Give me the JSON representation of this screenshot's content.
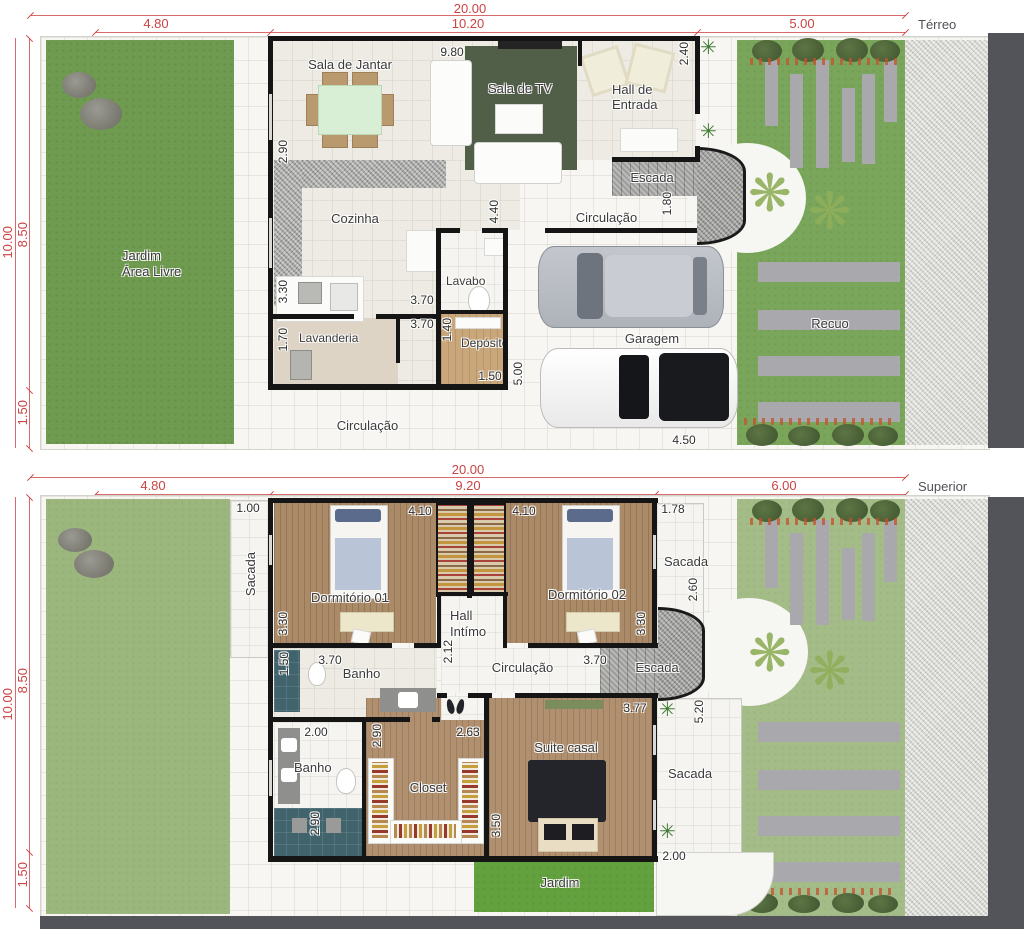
{
  "colors": {
    "dimension_red": "#cb4343",
    "label_dark": "#3b3b3b",
    "wall_black": "#151515",
    "grass_green": "#6f9b50",
    "grass_light": "#9cb77e",
    "rug_green": "#515e48",
    "wood_floor": "#ab8a67",
    "shower_teal": "#41646c",
    "paver_gray": "#a9a9ad",
    "street_gray": "#53545a"
  },
  "terreo": {
    "title": "Térreo",
    "dims": {
      "total": "20.00",
      "seg_left": "4.80",
      "seg_mid": "10.20",
      "seg_right": "5.00",
      "side_total": "10.00",
      "side_upper": "8.50",
      "side_lower": "1.50",
      "sala_width": "9.80",
      "hall_depth": "2.40",
      "jantar_height": "2.90",
      "cozinha_depth": "4.40",
      "escada_width": "1.80",
      "cozinha_height": "3.30",
      "cozinha_width": "3.70",
      "lavanderia_width": "3.70",
      "lavanderia_height": "1.70",
      "deposito_height": "1.40",
      "deposito_width": "1.50",
      "garagem_depth": "5.00",
      "garagem_width": "4.50"
    },
    "labels": {
      "sala_jantar": "Sala de Jantar",
      "sala_tv": "Sala de TV",
      "hall_line1": "Hall de",
      "hall_line2": "Entrada",
      "escada": "Escada",
      "circulacao_sup": "Circulação",
      "cozinha": "Cozinha",
      "lavabo": "Lavabo",
      "jardim_line1": "Jardim",
      "jardim_line2": "Área Livre",
      "lavanderia": "Lavanderia",
      "deposito": "Depósito",
      "garagem": "Garagem",
      "recuo": "Recuo",
      "circulacao_inf": "Circulação"
    }
  },
  "superior": {
    "title": "Superior",
    "dims": {
      "total": "20.00",
      "seg_left": "4.80",
      "seg_mid": "9.20",
      "seg_right": "6.00",
      "side_total": "10.00",
      "side_upper": "8.50",
      "side_lower": "1.50",
      "sacada_left_w": "1.00",
      "dorm1_w": "4.10",
      "dorm2_w": "4.10",
      "sacada_right_w": "1.78",
      "dorm1_h": "3.30",
      "dorm2_h": "3.30",
      "sacada_right_h": "2.60",
      "hall_w": "2.12",
      "banho1_shower": "1.50",
      "banho1_w": "3.70",
      "circulacao_w": "3.70",
      "banho2_w": "2.00",
      "banho2_h": "2.90",
      "closet_h": "2.90",
      "closet_w": "2.63",
      "suite_w": "3.77",
      "suite_h": "3.50",
      "sacada_inf_h": "5.20",
      "sacada_inf_w": "2.00"
    },
    "labels": {
      "sacada_left": "Sacada",
      "dorm1": "Dormitório 01",
      "dorm2": "Dormitório 02",
      "hall_line1": "Hall",
      "hall_line2": "Intímo",
      "sacada_right": "Sacada",
      "escada": "Escada",
      "circulacao": "Circulação",
      "banho1": "Banho",
      "banho2": "Banho",
      "closet": "Closet",
      "suite": "Suite casal",
      "sacada_inf": "Sacada",
      "jardim": "Jardim"
    }
  }
}
